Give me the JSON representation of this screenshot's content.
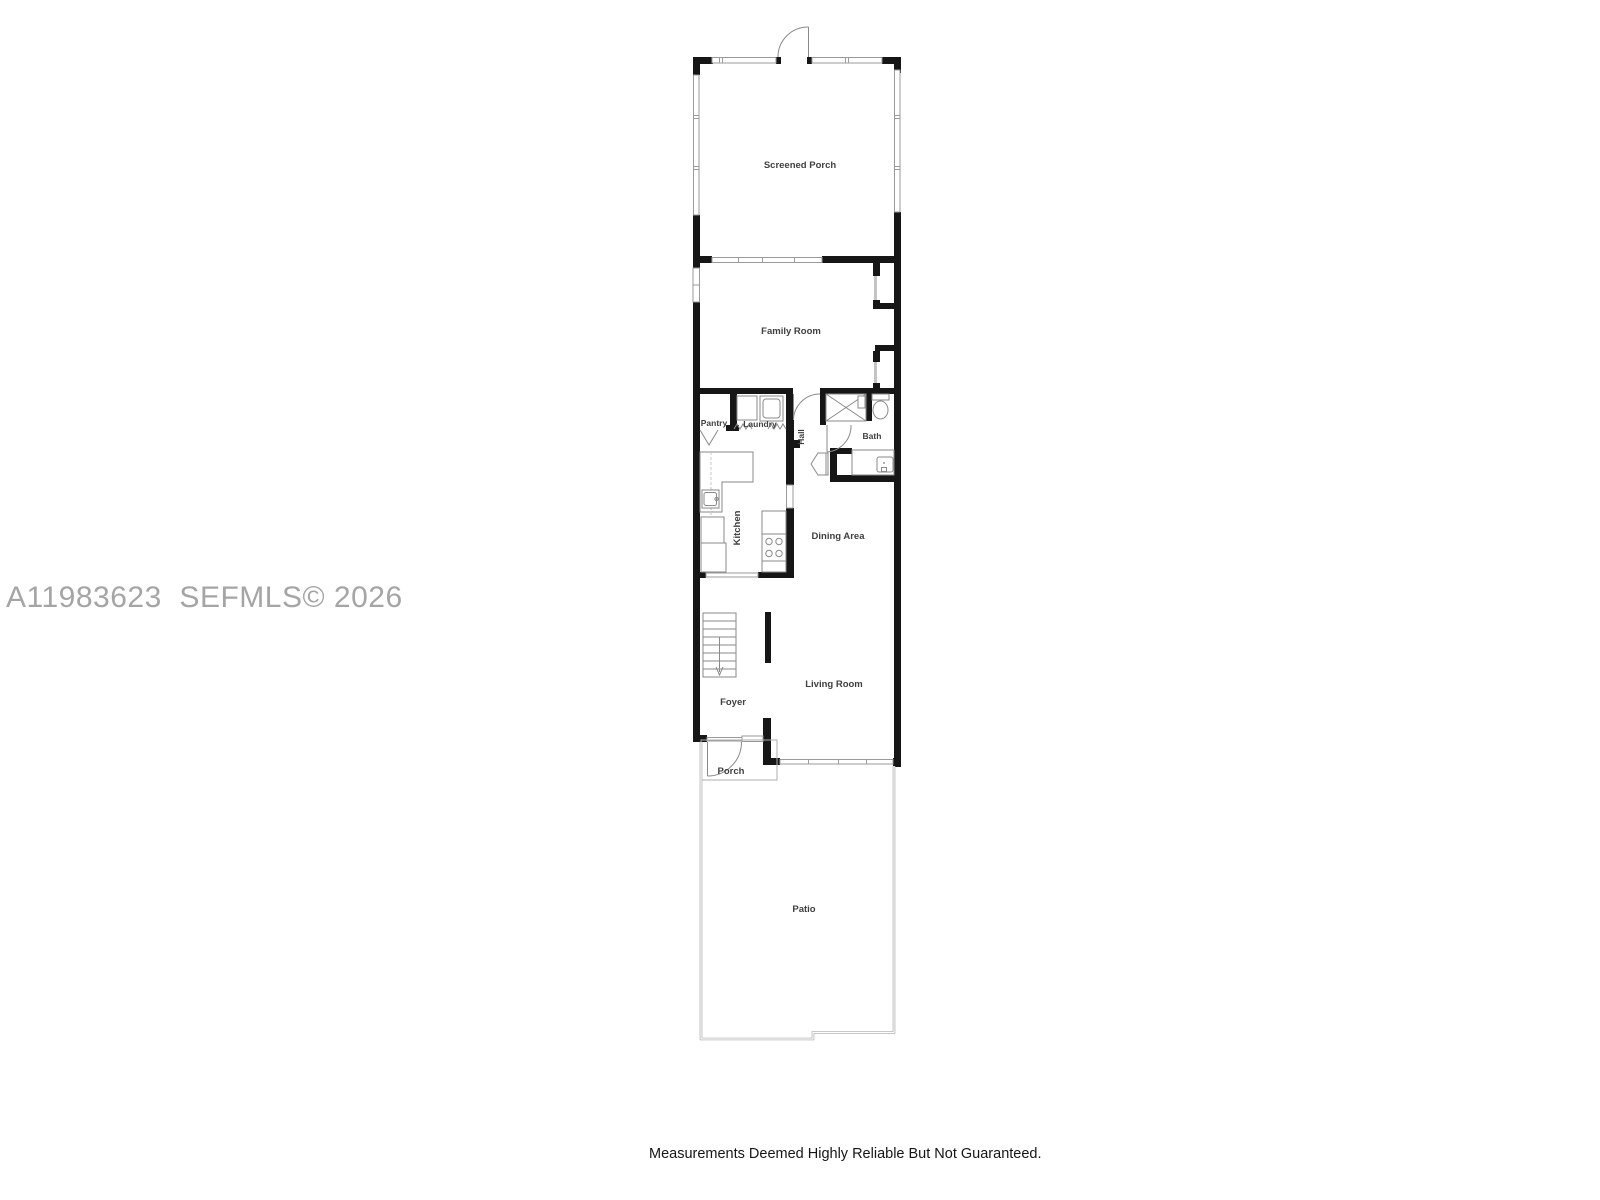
{
  "watermark": "A11983623  SEFMLS© 2026",
  "disclaimer": "Measurements Deemed Highly Reliable But Not Guaranteed.",
  "rooms": {
    "screened_porch": "Screened Porch",
    "family_room": "Family Room",
    "pantry": "Pantry",
    "laundry": "Laundry",
    "hall": "Hall",
    "bath": "Bath",
    "kitchen": "Kitchen",
    "dining_area": "Dining Area",
    "living_room": "Living Room",
    "foyer": "Foyer",
    "porch": "Porch",
    "patio": "Patio"
  },
  "colors": {
    "background": "#ffffff",
    "wall": "#161616",
    "screen_wall": "#9a9a9a",
    "fixture": "#8a8a8a",
    "patio_wall": "#a8a8a8",
    "label": "#3f3f3f",
    "watermark": "#a5a5a5",
    "disclaimer_text": "#161616"
  }
}
